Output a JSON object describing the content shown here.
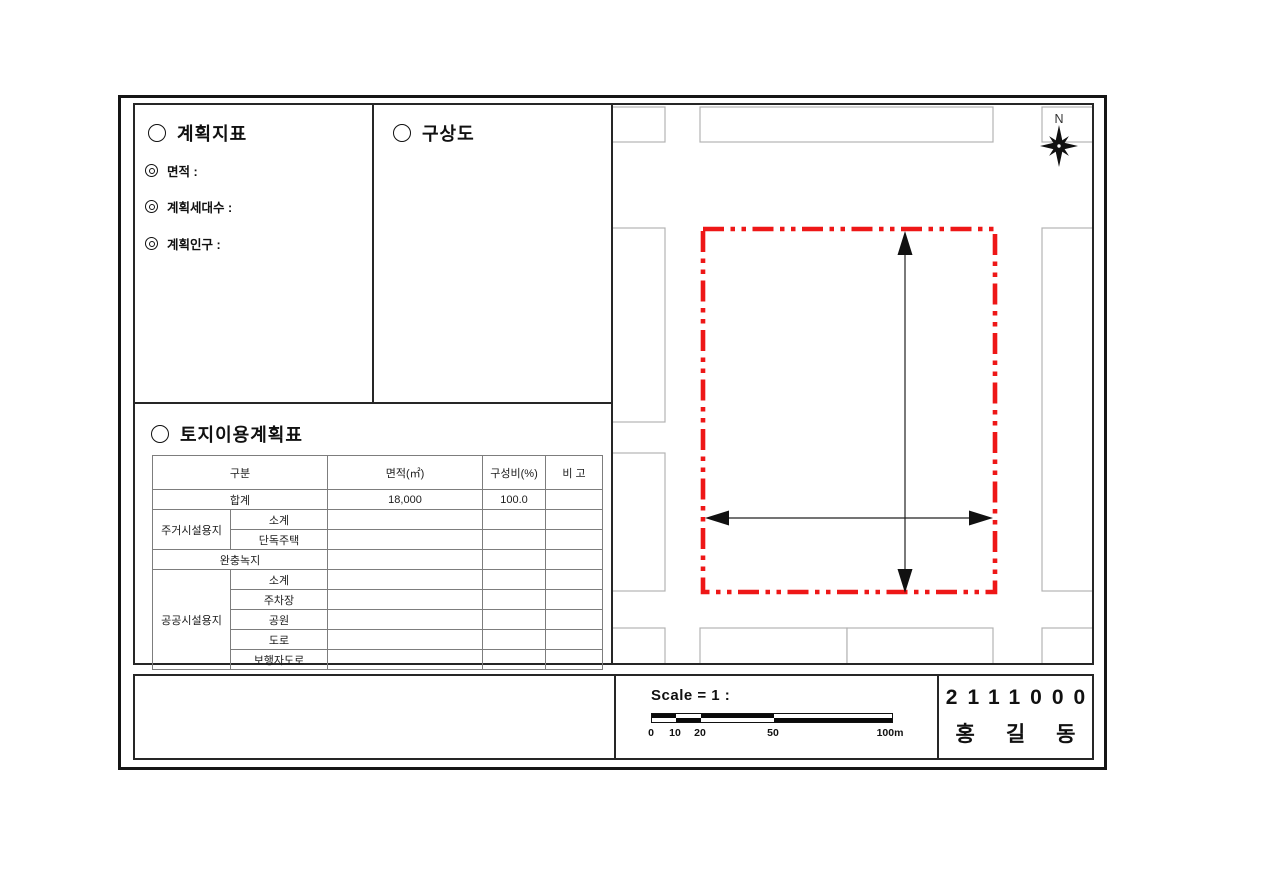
{
  "colors": {
    "boundary_red": "#ee1717",
    "road_gray": "#b3b3b3",
    "ink": "#111111"
  },
  "indicators": {
    "title": "계획지표",
    "items": [
      {
        "label": "면적 :"
      },
      {
        "label": "계획세대수 :"
      },
      {
        "label": "계획인구 :"
      }
    ]
  },
  "concept": {
    "title": "구상도"
  },
  "land_use": {
    "title": "토지이용계획표",
    "table": {
      "header": {
        "category": "구분",
        "area": "면적(㎡)",
        "ratio": "구성비(%)",
        "note": "비 고"
      },
      "total": {
        "label": "합계",
        "area": "18,000",
        "ratio": "100.0",
        "note": ""
      },
      "residential": {
        "group": "주거시설용지",
        "rows": [
          {
            "label": "소계"
          },
          {
            "label": "단독주택"
          }
        ]
      },
      "buffer": {
        "label": "완충녹지"
      },
      "public": {
        "group": "공공시설용지",
        "rows": [
          {
            "label": "소계"
          },
          {
            "label": "주차장"
          },
          {
            "label": "공원"
          },
          {
            "label": "도로"
          },
          {
            "label": "보행자도로"
          }
        ]
      }
    }
  },
  "map": {
    "north_label": "N"
  },
  "scale": {
    "label": "Scale = 1 :",
    "ticks": [
      "0",
      "10",
      "20",
      "50",
      "100m"
    ]
  },
  "title_block": {
    "code": "2111000",
    "name": "홍길동"
  }
}
